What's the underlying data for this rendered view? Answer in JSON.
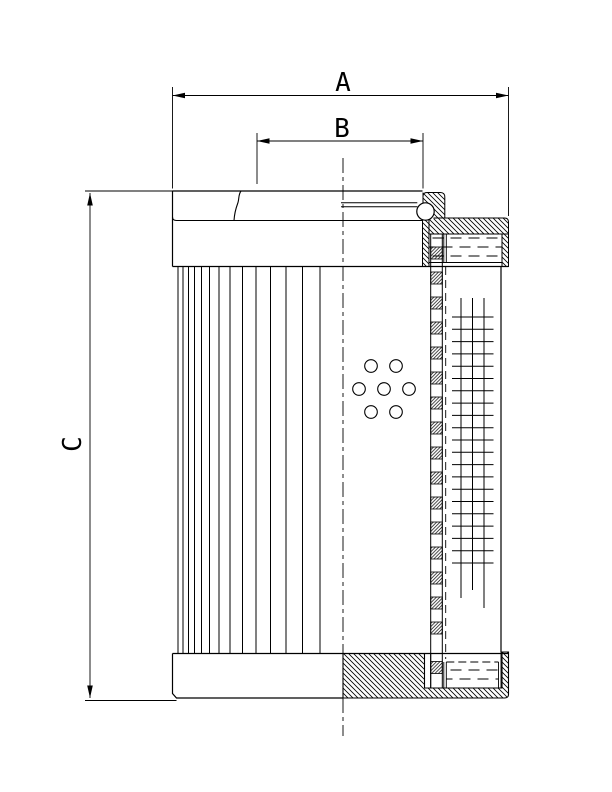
{
  "drawing": {
    "type": "technical-drawing",
    "subject": "hydraulic-filter-element-half-section",
    "colors": {
      "line": "#000000",
      "background": "#ffffff"
    },
    "dimensions": {
      "a_label": "A",
      "b_label": "B",
      "c_label": "C"
    }
  }
}
